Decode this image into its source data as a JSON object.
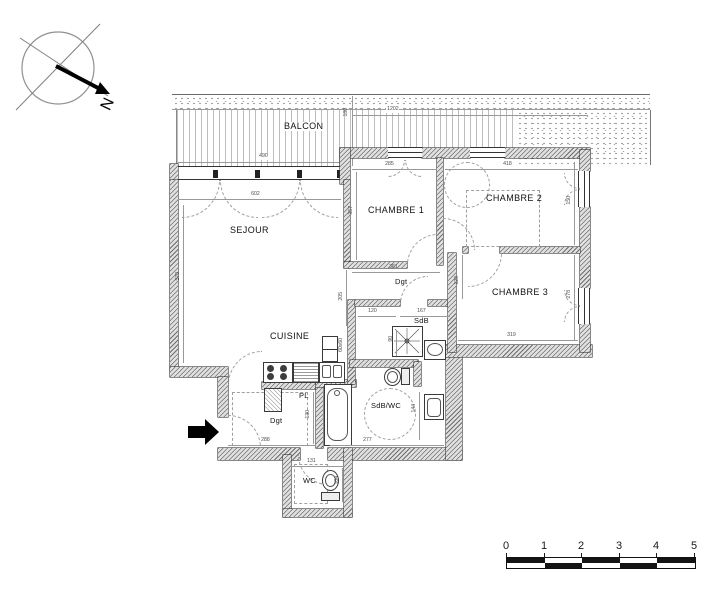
{
  "compass": {
    "north": "N"
  },
  "rooms": {
    "balcon": "BALCON",
    "sejour": "SEJOUR",
    "chambre1": "CHAMBRE 1",
    "chambre2": "CHAMBRE 2",
    "chambre3": "CHAMBRE 3",
    "cuisine": "CUISINE",
    "sdb": "SdB",
    "sdbwc": "SdB/WC",
    "wc": "WC",
    "pl": "PL",
    "dgt_upper": "Dgt",
    "dgt_lower": "Dgt"
  },
  "dims": {
    "balcony_length": "1202",
    "balcony_depth": "180",
    "sejour_bay": "490",
    "chambre1_width": "285",
    "chambre2_width": "418",
    "sejour_width": "602",
    "sejour_depth": "570",
    "chambre1_depth": "357",
    "chambre2_depth": "150",
    "chambre3_depth": "278",
    "chambre3_width": "319",
    "hall_width": "361",
    "chambre3_door": "120",
    "sdb_offset": "120",
    "sdb_width": "167",
    "mid_depth": "205",
    "shower_width": "90",
    "entry_width": "288",
    "pl_depth": "130",
    "sdbwc_width": "277",
    "sdbwc_depth": "144",
    "wc_width": "131",
    "wc_depth": "104",
    "kitchen_unit": "60x60"
  },
  "scale_bar": {
    "ticks": [
      "0",
      "1",
      "2",
      "3",
      "4",
      "5"
    ]
  }
}
